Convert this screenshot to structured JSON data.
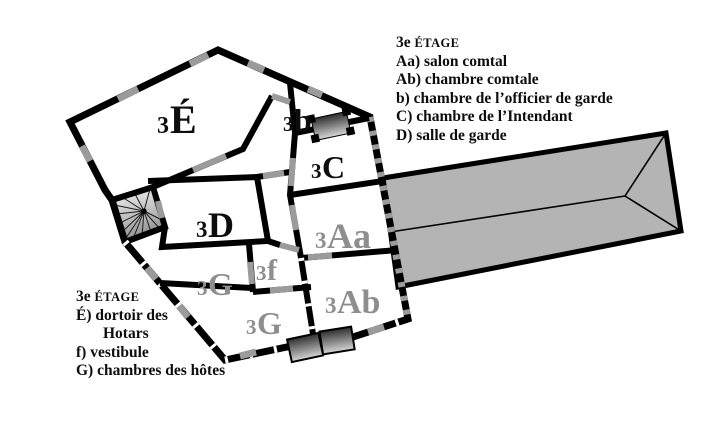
{
  "legend_top_right": {
    "title_prefix": "3e",
    "title_caps": "ÉTAGE",
    "items": [
      "Aa) salon comtal",
      "Ab) chambre comtale",
      "b) chambre de l’officier de garde",
      "C) chambre de l’Intendant",
      "D) salle de garde"
    ]
  },
  "legend_bottom_left": {
    "title_prefix": "3e",
    "title_caps": "ÉTAGE",
    "items": [
      {
        "text": "É) dortoir des",
        "indent": false
      },
      {
        "text": "Hotars",
        "indent": true
      },
      {
        "text": "f) vestibule",
        "indent": false
      },
      {
        "text": "G) chambres des hôtes",
        "indent": false
      }
    ]
  },
  "rooms": {
    "e": {
      "prefix": "3",
      "letter": "É"
    },
    "b": {
      "prefix": "3",
      "letter": "b"
    },
    "c": {
      "prefix": "3",
      "letter": "C"
    },
    "d": {
      "prefix": "3",
      "letter": "D"
    },
    "aa": {
      "prefix": "3",
      "letter": "Aa"
    },
    "ab": {
      "prefix": "3",
      "letter": "Ab"
    },
    "g_upper": {
      "prefix": "3",
      "letter": "G"
    },
    "f": {
      "prefix": "3",
      "letter": "f"
    },
    "g_lower": {
      "prefix": "3",
      "letter": "G"
    }
  },
  "symbols": {
    "staircase": "spiral-staircase",
    "fireplaces": 3
  },
  "colors": {
    "wall_black": "#000000",
    "dash_gray": "#9b9b9b",
    "roof_gray": "#b4b4b4",
    "room_label_gray": "#8e8e8e",
    "text_black": "#0d0d0d"
  }
}
